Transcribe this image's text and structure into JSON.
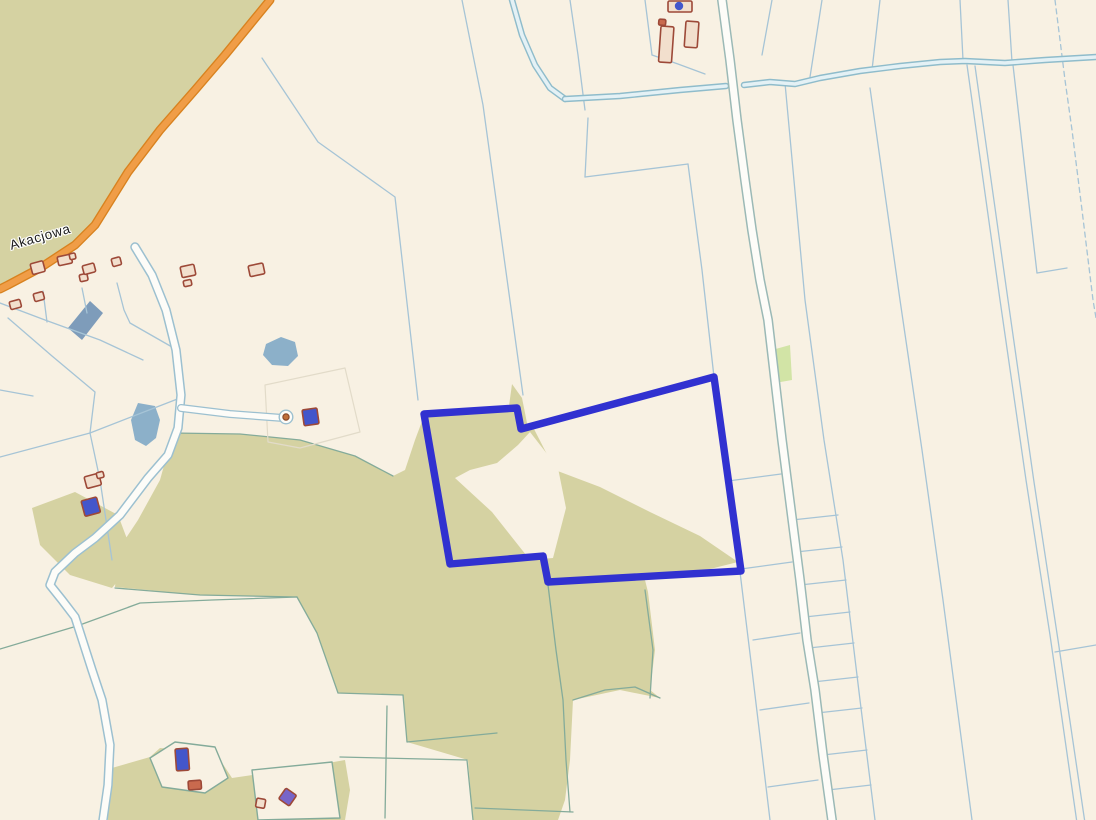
{
  "map": {
    "width": 1096,
    "height": 820,
    "street_label": "Akacjowa",
    "colors": {
      "bg": "#f8f1e3",
      "green": "#d5d2a2",
      "green_light": "#d2e4a6",
      "water": "#8cb0c9",
      "slab": "#7e9cba",
      "line_blue": "#a6c4d6",
      "line_teal": "#84ab9a",
      "line_faint": "#e2dbc9",
      "ditch_casing": "#8fbccb",
      "ditch_fill": "#e4f1f5",
      "road_fill": "#fdfcf8",
      "road_casing": "#9cc0d0",
      "road_casing_green": "#9bb9b6",
      "orange_fill": "#f09d47",
      "orange_casing": "#d8821f",
      "highlight": "#3131d0",
      "bld_stroke": "#9d4938",
      "bld_fill": "#f2dfcd",
      "bld_blue": "#4356cb",
      "bld_purple": "#7765c8",
      "bld_red": "#c96a4e"
    },
    "highlight_parcel": {
      "points": "424,414 517,408 521,429 714,377 741,571 548,582 543,556 450,564",
      "stroke_width": 7.4
    },
    "shapes": [
      {
        "t": "pg",
        "p": "0,0 268,0 243,28 215,62 184,100 150,140 118,185 88,235 60,255 28,272 0,285",
        "f": "green",
        "name": "forest-area-northwest"
      },
      {
        "t": "pg",
        "p": "32,508 75,492 118,515 135,560 112,588 70,575 40,545",
        "f": "green",
        "name": "green-area-west"
      },
      {
        "t": "pg",
        "p": "173,433 240,434 300,440 355,456 393,476 405,470 415,440 424,416 517,410 522,430 534,429 555,470 600,487 650,512 700,536 738,562 690,574 645,580 648,592 655,650 650,690 660,698 620,690 573,700 570,760 565,800 558,820 473,820 468,760 407,742 403,695 338,693 317,633 297,597 200,595 115,587 118,550 138,520 160,480",
        "f": "green",
        "name": "green-area-central"
      },
      {
        "t": "pg",
        "p": "506,428 512,384 522,398 528,428",
        "f": "green",
        "name": "green-spike"
      },
      {
        "t": "pg",
        "p": "105,770 150,757 160,748 215,752 232,778 300,768 345,760 350,790 345,820 108,820",
        "f": "green",
        "name": "green-area-south"
      },
      {
        "t": "pg",
        "p": "772,350 790,345 792,380 775,383",
        "f": "green_light",
        "name": "green-patch-east"
      },
      {
        "t": "pg",
        "p": "530,432 558,468 566,508 553,558 530,560 492,512 455,478 470,470 497,463 518,445",
        "f": "bg",
        "name": "clearing"
      },
      {
        "t": "pg",
        "p": "150,758 175,742 215,747 228,778 205,793 162,787",
        "f": "bg",
        "s": "line_teal",
        "sw": 1.4,
        "name": "parcel-island"
      },
      {
        "t": "pg",
        "p": "252,770 332,762 340,818 258,820",
        "f": "bg",
        "s": "line_teal",
        "sw": 1.4,
        "name": "parcel-island"
      },
      {
        "t": "pg",
        "p": "90,301 103,313 82,340 68,328",
        "f": "slab",
        "name": "large-building"
      },
      {
        "t": "pg",
        "p": "266,344 281,337 295,342 298,356 288,366 272,365 263,355",
        "f": "water",
        "name": "pond"
      },
      {
        "t": "pg",
        "p": "138,403 155,406 160,420 156,438 146,446 135,440 131,420",
        "f": "water",
        "name": "pond"
      },
      {
        "t": "pl",
        "p": "462,0 476,70 483,105 523,395",
        "s": "line_blue",
        "name": "parcel-boundary-line"
      },
      {
        "t": "pl",
        "p": "548,585 556,650 563,700 566,760 570,812",
        "s": "line_teal",
        "name": "parcel-boundary-line"
      },
      {
        "t": "pl",
        "p": "570,0 578,55 585,110",
        "s": "line_blue",
        "name": "parcel-boundary-line"
      },
      {
        "t": "pl",
        "p": "588,118 585,177",
        "s": "line_blue",
        "name": "parcel-boundary-line"
      },
      {
        "t": "pl",
        "p": "585,177 688,164",
        "s": "line_blue",
        "name": "parcel-boundary-line"
      },
      {
        "t": "pl",
        "p": "688,164 702,270 714,377",
        "s": "line_blue",
        "name": "parcel-boundary-line"
      },
      {
        "t": "pl",
        "p": "645,0 652,55",
        "s": "line_blue",
        "name": "parcel-boundary-line"
      },
      {
        "t": "pl",
        "p": "652,55 678,64 705,74",
        "s": "line_blue",
        "name": "parcel-boundary-line"
      },
      {
        "t": "pl",
        "p": "772,0 762,55",
        "s": "line_blue",
        "name": "parcel-boundary-line"
      },
      {
        "t": "pl",
        "p": "822,0 810,77",
        "s": "line_blue",
        "name": "parcel-boundary-line"
      },
      {
        "t": "pl",
        "p": "880,0 872,70",
        "s": "line_blue",
        "name": "parcel-boundary-line"
      },
      {
        "t": "pl",
        "p": "960,0 963,60",
        "s": "line_blue",
        "name": "parcel-boundary-line"
      },
      {
        "t": "pl",
        "p": "1008,0 1012,62",
        "s": "line_blue",
        "name": "parcel-boundary-line"
      },
      {
        "t": "pl",
        "p": "1055,0 1065,80 1072,130 1082,210 1093,300 1096,318",
        "s": "line_blue",
        "dash": "5,4",
        "name": "dashed-boundary-line"
      },
      {
        "t": "pl",
        "p": "785,83 805,300 824,440 843,560 860,700 875,820",
        "s": "line_blue",
        "name": "parcel-boundary-line"
      },
      {
        "t": "pl",
        "p": "870,88 900,300 922,450 943,600 972,820",
        "s": "line_blue",
        "name": "parcel-boundary-line"
      },
      {
        "t": "pl",
        "p": "967,65 1000,300 1026,480 1050,635 1077,823",
        "s": "line_blue",
        "name": "parcel-boundary-line"
      },
      {
        "t": "pl",
        "p": "975,66 1008,300 1034,482 1058,640 1085,823",
        "s": "line_blue",
        "name": "parcel-boundary-line"
      },
      {
        "t": "pl",
        "p": "1055,652 1096,645",
        "s": "line_blue",
        "name": "parcel-boundary-line"
      },
      {
        "t": "pl",
        "p": "1013,65 1025,170 1037,273",
        "s": "line_blue",
        "name": "parcel-boundary-line"
      },
      {
        "t": "pl",
        "p": "1037,273 1067,268",
        "s": "line_blue",
        "name": "parcel-boundary-line"
      },
      {
        "t": "pl",
        "p": "792,520 838,515",
        "s": "line_blue",
        "name": "parcel-boundary-line"
      },
      {
        "t": "pl",
        "p": "796,552 842,547",
        "s": "line_blue",
        "name": "parcel-boundary-line"
      },
      {
        "t": "pl",
        "p": "800,585 846,580",
        "s": "line_blue",
        "name": "parcel-boundary-line"
      },
      {
        "t": "pl",
        "p": "805,617 850,612",
        "s": "line_blue",
        "name": "parcel-boundary-line"
      },
      {
        "t": "pl",
        "p": "809,648 854,643",
        "s": "line_blue",
        "name": "parcel-boundary-line"
      },
      {
        "t": "pl",
        "p": "813,682 858,677",
        "s": "line_blue",
        "name": "parcel-boundary-line"
      },
      {
        "t": "pl",
        "p": "817,713 862,708",
        "s": "line_blue",
        "name": "parcel-boundary-line"
      },
      {
        "t": "pl",
        "p": "823,755 867,750",
        "s": "line_blue",
        "name": "parcel-boundary-line"
      },
      {
        "t": "pl",
        "p": "828,790 871,785",
        "s": "line_blue",
        "name": "parcel-boundary-line"
      },
      {
        "t": "pl",
        "p": "728,481 781,474",
        "s": "line_blue",
        "name": "parcel-boundary-line"
      },
      {
        "t": "pl",
        "p": "741,569 792,562",
        "s": "line_blue",
        "name": "parcel-boundary-line"
      },
      {
        "t": "pl",
        "p": "753,640 800,633",
        "s": "line_blue",
        "name": "parcel-boundary-line"
      },
      {
        "t": "pl",
        "p": "760,710 809,703",
        "s": "line_blue",
        "name": "parcel-boundary-line"
      },
      {
        "t": "pl",
        "p": "768,787 818,780",
        "s": "line_blue",
        "name": "parcel-boundary-line"
      },
      {
        "t": "pl",
        "p": "740,572 752,670 770,820",
        "s": "line_blue",
        "name": "parcel-boundary-line"
      },
      {
        "t": "pl",
        "p": "262,58 318,142 395,197 418,400",
        "s": "line_blue",
        "name": "parcel-boundary-line"
      },
      {
        "t": "pl",
        "p": "0,303 45,320 100,340 143,360",
        "s": "line_blue",
        "name": "parcel-boundary-line"
      },
      {
        "t": "pl",
        "p": "43,291 47,322",
        "s": "line_blue",
        "name": "parcel-boundary-line"
      },
      {
        "t": "pl",
        "p": "82,288 87,313",
        "s": "line_blue",
        "name": "parcel-boundary-line"
      },
      {
        "t": "pl",
        "p": "117,283 124,310 130,323 172,347 181,360",
        "s": "line_blue",
        "name": "parcel-boundary-line"
      },
      {
        "t": "pl",
        "p": "8,318 52,356 95,392 90,433",
        "s": "line_blue",
        "name": "parcel-boundary-line"
      },
      {
        "t": "pl",
        "p": "0,457 90,433 180,398",
        "s": "line_blue",
        "name": "parcel-boundary-line"
      },
      {
        "t": "pl",
        "p": "90,433 100,480 112,560",
        "s": "line_blue",
        "name": "parcel-boundary-line"
      },
      {
        "t": "pl",
        "p": "0,390 33,396",
        "s": "line_blue",
        "name": "parcel-boundary-line"
      },
      {
        "t": "pl",
        "p": "0,649 77,626 140,603 212,600 297,597",
        "s": "line_teal",
        "name": "parcel-boundary-line"
      },
      {
        "t": "pl",
        "p": "115,588 200,595 297,597",
        "s": "line_teal",
        "name": "parcel-boundary-line"
      },
      {
        "t": "pl",
        "p": "297,597 317,633 338,693 403,695",
        "s": "line_teal",
        "name": "parcel-boundary-line"
      },
      {
        "t": "pl",
        "p": "403,695 407,742 497,733",
        "s": "line_teal",
        "name": "parcel-boundary-line"
      },
      {
        "t": "pl",
        "p": "340,757 467,760 470,790 473,820",
        "s": "line_teal",
        "name": "parcel-boundary-line"
      },
      {
        "t": "pl",
        "p": "475,808 573,812",
        "s": "line_teal",
        "name": "parcel-boundary-line"
      },
      {
        "t": "pl",
        "p": "573,700 605,690 635,687 660,698",
        "s": "line_teal",
        "name": "parcel-boundary-line"
      },
      {
        "t": "pl",
        "p": "645,590 653,650 650,698",
        "s": "line_teal",
        "name": "parcel-boundary-line"
      },
      {
        "t": "pl",
        "p": "173,433 240,434 300,440 355,456 393,476",
        "s": "line_teal",
        "name": "parcel-boundary-line"
      },
      {
        "t": "pl",
        "p": "387,706 385,818",
        "s": "line_teal",
        "name": "parcel-boundary-line"
      },
      {
        "t": "pg",
        "p": "265,385 345,368 360,432 300,448 268,442",
        "f": "none",
        "s": "line_faint",
        "sw": 1.2,
        "name": "faint-parcel-outline"
      },
      {
        "t": "ditch",
        "p": "512,0 522,35 535,65 550,88 565,99",
        "name": "ditch"
      },
      {
        "t": "ditch",
        "p": "565,99 620,96 680,90 726,86",
        "name": "ditch"
      },
      {
        "t": "ditch",
        "p": "744,85 770,82 795,84 820,78 860,71 900,66 940,62 965,61 1005,63 1045,60 1096,57",
        "name": "ditch"
      },
      {
        "t": "road",
        "p": "135,247 152,275 166,310 176,350 181,395 178,428 168,455 148,478 120,515 95,538 75,553 55,572 50,585 62,600 75,617 92,670 102,700 110,745 108,785 103,820",
        "cas": "road_casing",
        "fill": "road_fill",
        "cw": 9.5,
        "fw": 6.5,
        "name": "road-track-west"
      },
      {
        "t": "road",
        "p": "181,408 230,414 283,418",
        "cas": "road_casing",
        "fill": "road_fill",
        "cw": 8,
        "fw": 5.5,
        "name": "road-culdesac"
      },
      {
        "t": "c",
        "cx": 286,
        "cy": 417,
        "r": 6.8,
        "f": "road_fill",
        "s": "road_casing",
        "sw": 1.4,
        "name": "culdesac-bulb"
      },
      {
        "t": "c",
        "cx": 286,
        "cy": 417,
        "r": 3.1,
        "f": "#c06f3a",
        "s": "#8a4a2a",
        "sw": 1.2,
        "name": "point-feature"
      },
      {
        "t": "road",
        "p": "722,0 730,60 737,120 745,180 752,230 760,280 768,320 775,380 782,440 791,510 800,580 807,640 815,690 823,755 832,820",
        "cas": "road_casing_green",
        "fill": "road_fill",
        "cw": 10,
        "fw": 7,
        "name": "road-north-south"
      },
      {
        "t": "road",
        "p": "270,0 252,22 225,55 195,90 160,130 128,172 95,225 75,245 40,268 8,285 0,289",
        "cas": "orange_casing",
        "fill": "orange_fill",
        "cw": 9,
        "fw": 6.3,
        "name": "road-akacjowa"
      },
      {
        "t": "pg",
        "p": "424,414 517,408 521,429 714,377 741,571 548,582 543,556 450,564",
        "f": "none",
        "s": "highlight",
        "sw": 7.4,
        "name": "highlighted-parcel-outline",
        "i": "true"
      },
      {
        "t": "b",
        "x": 30,
        "y": 264,
        "w": 13,
        "h": 11,
        "rot": -15,
        "name": "building"
      },
      {
        "t": "b",
        "x": 9,
        "y": 302,
        "w": 11,
        "h": 8,
        "rot": -15,
        "name": "building"
      },
      {
        "t": "b",
        "x": 33,
        "y": 294,
        "w": 10,
        "h": 8,
        "rot": -15,
        "name": "building"
      },
      {
        "t": "b",
        "x": 57,
        "y": 257,
        "w": 14,
        "h": 9,
        "rot": -12,
        "name": "building"
      },
      {
        "t": "b",
        "x": 69,
        "y": 254,
        "w": 6,
        "h": 6,
        "rot": -12,
        "name": "building"
      },
      {
        "t": "b",
        "x": 79,
        "y": 275,
        "w": 8,
        "h": 7,
        "rot": -12,
        "name": "building"
      },
      {
        "t": "b",
        "x": 82,
        "y": 266,
        "w": 12,
        "h": 9,
        "rot": -15,
        "name": "building"
      },
      {
        "t": "b",
        "x": 111,
        "y": 259,
        "w": 9,
        "h": 8,
        "rot": -15,
        "name": "building"
      },
      {
        "t": "b",
        "x": 180,
        "y": 267,
        "w": 14,
        "h": 11,
        "rot": -12,
        "name": "building"
      },
      {
        "t": "b",
        "x": 183,
        "y": 281,
        "w": 8,
        "h": 6,
        "rot": -12,
        "name": "building"
      },
      {
        "t": "b",
        "x": 248,
        "y": 266,
        "w": 15,
        "h": 11,
        "rot": -12,
        "name": "building"
      },
      {
        "t": "b",
        "x": 668,
        "y": 1,
        "w": 24,
        "h": 11,
        "rot": 0,
        "name": "building"
      },
      {
        "t": "c",
        "cx": 679,
        "cy": 6,
        "r": 4.2,
        "f": "bld_blue",
        "name": "address-point"
      },
      {
        "t": "b",
        "x": 659,
        "y": 19,
        "w": 7,
        "h": 6,
        "rot": 5,
        "f": "bld_red",
        "name": "building"
      },
      {
        "t": "b",
        "x": 661,
        "y": 26,
        "w": 13,
        "h": 36,
        "rot": 4,
        "name": "building"
      },
      {
        "t": "b",
        "x": 686,
        "y": 21,
        "w": 13,
        "h": 26,
        "rot": 4,
        "name": "building"
      },
      {
        "t": "b",
        "x": 84,
        "y": 477,
        "w": 15,
        "h": 12,
        "rot": -15,
        "name": "building"
      },
      {
        "t": "b",
        "x": 96,
        "y": 473,
        "w": 7,
        "h": 6,
        "rot": -15,
        "name": "building"
      },
      {
        "t": "b",
        "x": 81,
        "y": 501,
        "w": 16,
        "h": 16,
        "rot": -15,
        "f": "bld_blue",
        "name": "building-address-point"
      },
      {
        "t": "b",
        "x": 302,
        "y": 410,
        "w": 15,
        "h": 16,
        "rot": -8,
        "f": "bld_blue",
        "name": "building-address-point"
      },
      {
        "t": "b",
        "x": 175,
        "y": 749,
        "w": 13,
        "h": 22,
        "rot": -4,
        "f": "bld_blue",
        "name": "building-address-point"
      },
      {
        "t": "b",
        "x": 188,
        "y": 781,
        "w": 13,
        "h": 9,
        "rot": -4,
        "f": "bld_red",
        "name": "building"
      },
      {
        "t": "b",
        "x": 257,
        "y": 798,
        "w": 9,
        "h": 9,
        "rot": 10,
        "name": "building"
      },
      {
        "t": "b",
        "x": 286,
        "y": 788,
        "w": 13,
        "h": 13,
        "rot": 35,
        "f": "bld_purple",
        "name": "building-address-point"
      }
    ]
  }
}
